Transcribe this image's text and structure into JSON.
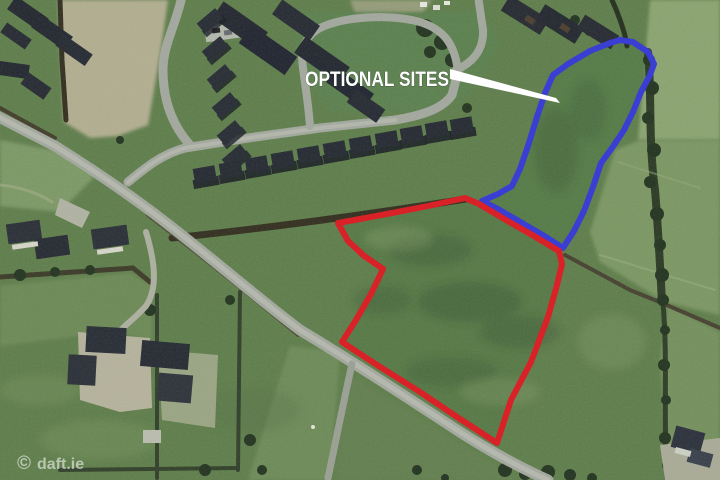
{
  "annotations": {
    "label": "OPTIONAL SITES",
    "label_color": "#ffffff",
    "arrow_points": "450,69 556,98 560,103 450,79",
    "red_outline_color": "#d92128",
    "red_outline_points": "465,198 428,206 392,213 360,219 338,223 348,241 363,255 383,269 371,294 356,320 342,342 377,365 420,392 460,419 497,443 511,400 531,362 548,317 557,285 562,264 559,251 534,236 506,220 479,204",
    "blue_outline_color": "#3b3ed2",
    "blue_outline_points": "610,43 590,51 568,64 553,75 545,93 537,117 528,146 520,169 512,186 498,194 482,201 498,209 522,223 546,237 563,248 574,231 584,211 593,187 601,163 612,148 624,130 633,112 641,92 650,75 654,64 648,52 633,42 620,40"
  },
  "watermark": {
    "symbol": "©",
    "text": "daft.ie"
  }
}
